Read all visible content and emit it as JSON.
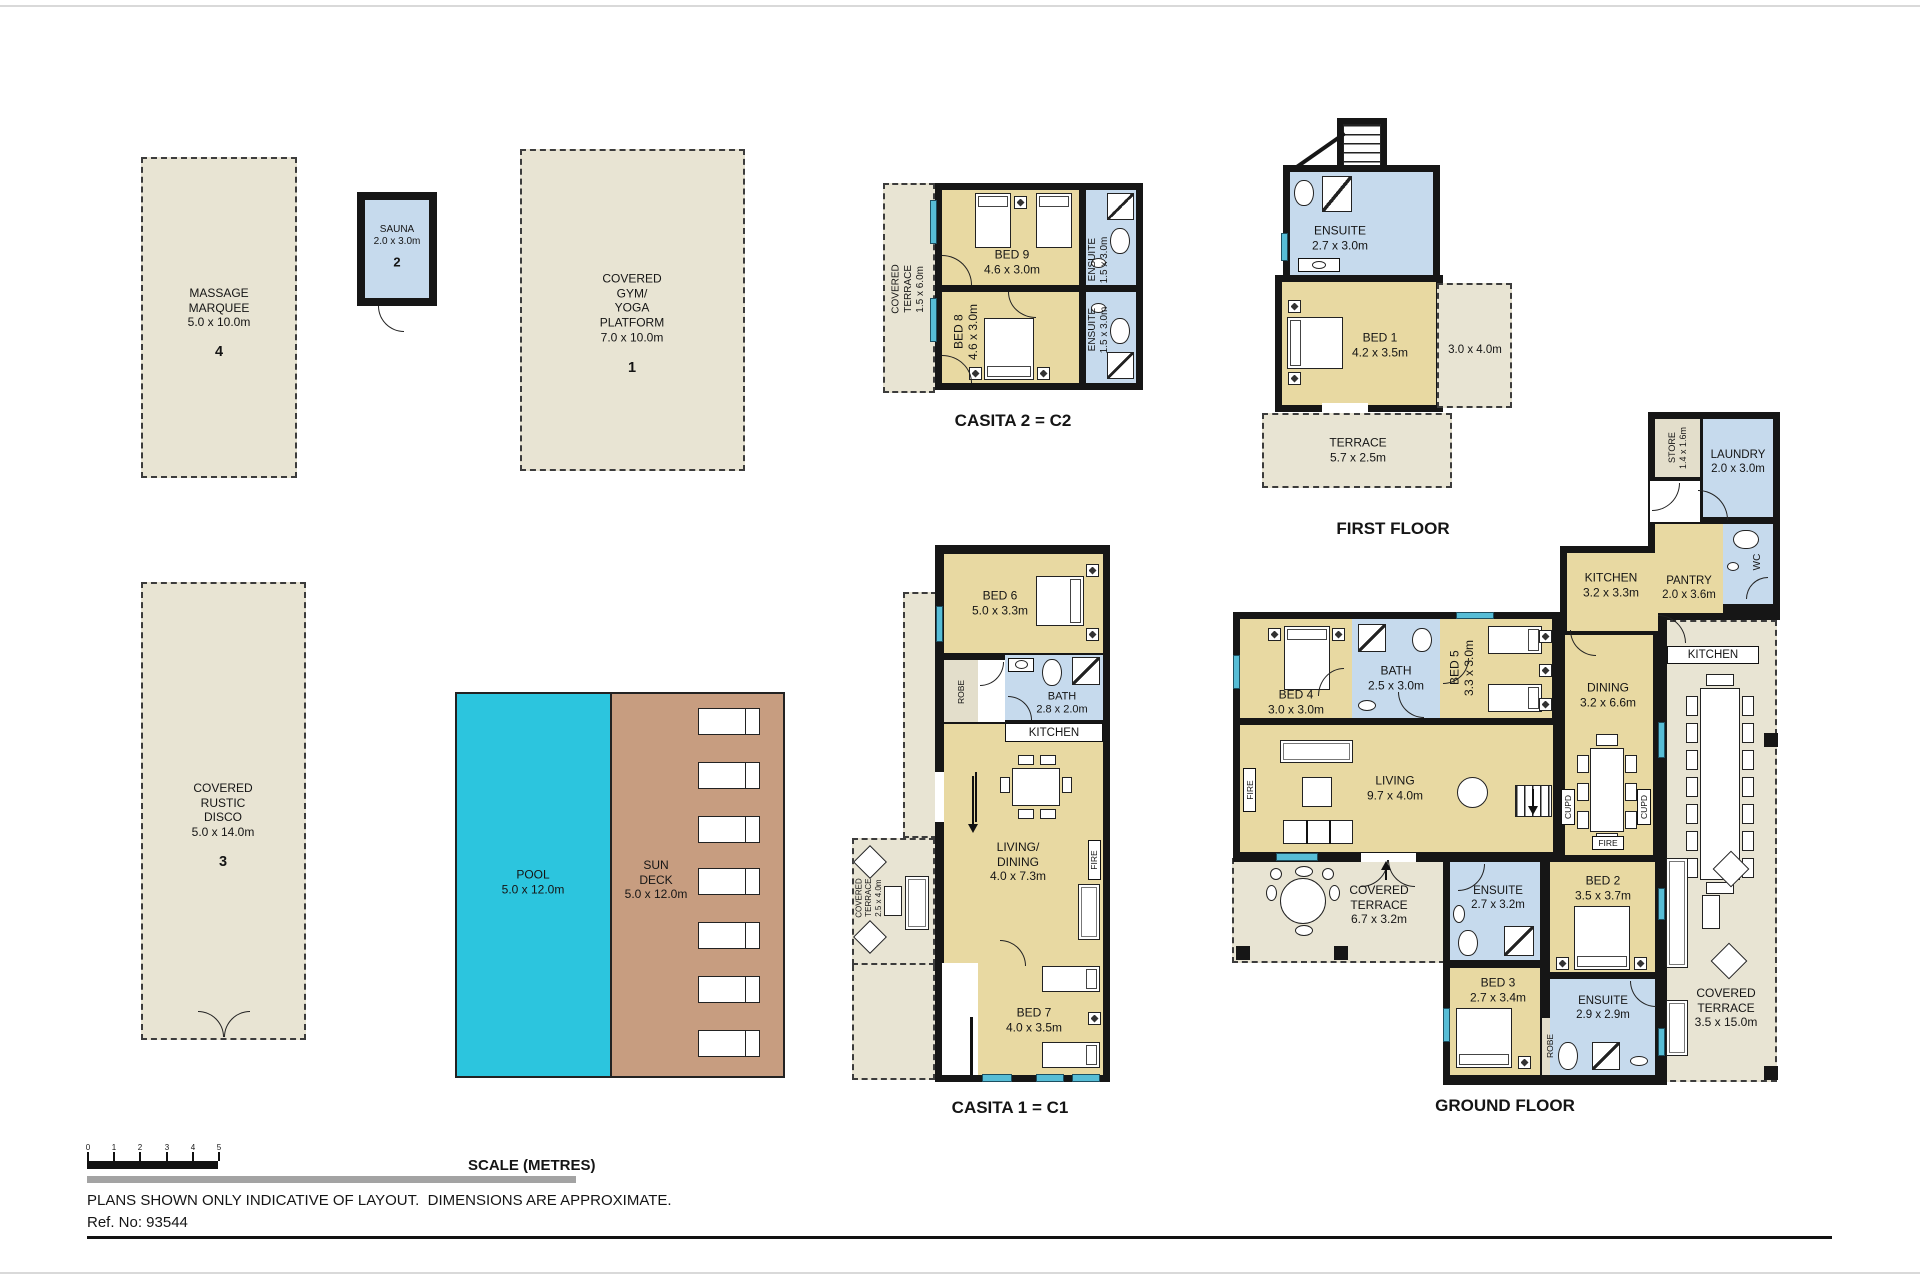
{
  "meta": {
    "scale_label": "SCALE (METRES)",
    "scale_ticks": [
      "0",
      "1",
      "2",
      "3",
      "4",
      "5"
    ],
    "disclaimer": "PLANS SHOWN ONLY INDICATIVE OF LAYOUT.  DIMENSIONS ARE APPROXIMATE.",
    "ref": "Ref. No: 93544"
  },
  "titles": {
    "casita2": "CASITA 2 = C2",
    "casita1": "CASITA 1 = C1",
    "first_floor": "FIRST FLOOR",
    "ground_floor": "GROUND FLOOR"
  },
  "buildings": {
    "massage": {
      "label": "MASSAGE\nMARQUEE\n5.0 x 10.0m",
      "num": "4"
    },
    "sauna": {
      "label": "SAUNA\n2.0 x 3.0m",
      "num": "2"
    },
    "gym": {
      "label": "COVERED\nGYM/\nYOGA\nPLATFORM\n7.0 x 10.0m",
      "num": "1"
    },
    "disco": {
      "label": "COVERED\nRUSTIC\nDISCO\n5.0 x 14.0m",
      "num": "3"
    },
    "pool": {
      "label": "POOL\n5.0 x 12.0m"
    },
    "deck": {
      "label": "SUN\nDECK\n5.0 x 12.0m"
    }
  },
  "casita2": {
    "terrace": "COVERED\nTERRACE\n1.5 x 6.0m",
    "bed9": "BED 9\n4.6 x 3.0m",
    "bed8": "BED 8\n4.6 x 3.0m",
    "ensuite_top": "ENSUITE\n1.5 x 3.0m",
    "ensuite_bottom": "ENSUITE\n1.5 x 3.0m"
  },
  "first_floor": {
    "ensuite": "ENSUITE\n2.7 x 3.0m",
    "bed1": "BED 1\n4.2 x 3.5m",
    "open_area": "3.0 x 4.0m",
    "terrace": "TERRACE\n5.7 x 2.5m"
  },
  "ground_floor": {
    "store": "STORE\n1.4 x 1.6m",
    "laundry": "LAUNDRY\n2.0 x 3.0m",
    "wc": "WC",
    "pantry": "PANTRY\n2.0 x 3.6m",
    "kitchen": "KITCHEN\n3.2 x 3.3m",
    "outdoor_kitchen": "KITCHEN",
    "dining": "DINING\n3.2 x 6.6m",
    "bed4": "BED 4\n3.0 x 3.0m",
    "bath": "BATH\n2.5 x 3.0m",
    "bed5": "BED 5\n3.3 x 3.0m",
    "living": "LIVING\n9.7 x 4.0m",
    "terrace": "COVERED\nTERRACE\n6.7 x 3.2m",
    "ensuite3": "ENSUITE\n2.7 x 3.2m",
    "bed3": "BED 3\n2.7 x 3.4m",
    "robe": "ROBE",
    "bed2": "BED 2\n3.5 x 3.7m",
    "ensuite2": "ENSUITE\n2.9 x 2.9m",
    "terrace_right": "COVERED\nTERRACE\n3.5 x 15.0m",
    "cupd": "CUPD",
    "fire": "FIRE"
  },
  "casita1": {
    "bed6": "BED 6\n5.0 x 3.3m",
    "robe": "ROBE",
    "bath": "BATH\n2.8 x 2.0m",
    "kitchen": "KITCHEN",
    "living": "LIVING/\nDINING\n4.0 x 7.3m",
    "fire": "FIRE",
    "terrace": "COVERED\nTERRACE\n2.5 x 4.0m",
    "bed7": "BED 7\n4.0 x 3.5m"
  },
  "colors": {
    "room_tan": "#e8d9a2",
    "wet_blue": "#c6daed",
    "outdoor_beige": "#e8e4d3",
    "pool_cyan": "#2cc5de",
    "deck_brown": "#c79d80",
    "wall_black": "#161616"
  }
}
